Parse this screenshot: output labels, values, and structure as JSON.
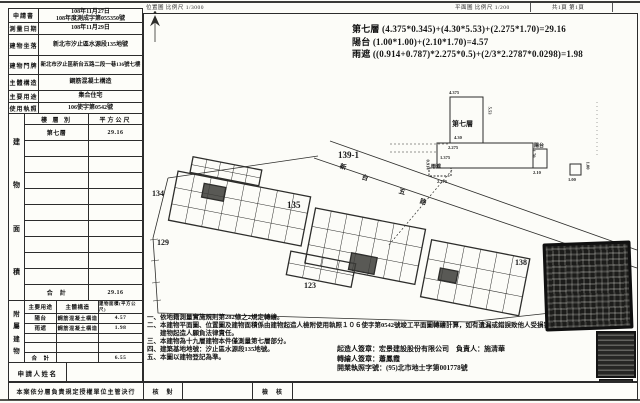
{
  "top": {
    "location_scale": "位置圖 比例尺 1/3000",
    "plan_scale": "平面圖 比例尺 1/200",
    "page_info": "共1頁 第1頁"
  },
  "calc_lines": [
    "第七層 (4.375*0.345)+(4.30*5.53)+(2.275*1.70)=29.16",
    "陽台 (1.00*1.00)+(2.10*1.70)=4.57",
    "雨遮 ((0.914+0.787)*2.275*0.5)+(2/3*2.2787*0.0298)=1.98"
  ],
  "form": {
    "fields": [
      {
        "label": "申請書",
        "lines": [
          "108年11月27日",
          "108年度測成字第055350號"
        ]
      },
      {
        "label": "測量日期",
        "lines": [
          "108年11月29日"
        ]
      },
      {
        "label": "建物坐落",
        "lines": [
          "新北市汐止區水源段135地號"
        ]
      },
      {
        "label": "建物門牌",
        "lines": [
          "新北市汐止區新台五路二段一巷136號七樓"
        ]
      },
      {
        "label": "主體構造",
        "lines": [
          "鋼筋混凝土構造"
        ]
      },
      {
        "label": "主要用途",
        "lines": [
          "集合住宅"
        ]
      },
      {
        "label": "使用執照",
        "lines": [
          "106使字第0542號"
        ]
      }
    ],
    "area_table": {
      "side_label": "建物面積",
      "headers": [
        "樓 層 別",
        "平方公尺"
      ],
      "rows": [
        [
          "第七層",
          "29.16"
        ],
        [
          "",
          ""
        ],
        [
          "",
          ""
        ],
        [
          "",
          ""
        ],
        [
          "",
          ""
        ],
        [
          "",
          ""
        ],
        [
          "",
          ""
        ],
        [
          "",
          ""
        ],
        [
          "",
          ""
        ],
        [
          "",
          ""
        ],
        [
          "合　計",
          "29.16"
        ]
      ]
    },
    "annex_table": {
      "side_label": "附屬建物",
      "headers": [
        "主要用途",
        "主體構造",
        "建物面積(平方公尺)"
      ],
      "rows": [
        [
          "陽台",
          "鋼筋混凝土構造",
          "4.57"
        ],
        [
          "雨遮",
          "鋼筋混凝土構造",
          "1.98"
        ],
        [
          "",
          "",
          ""
        ],
        [
          "",
          "",
          ""
        ],
        [
          "合　計",
          "",
          "6.55"
        ]
      ]
    },
    "applicant_label": "申請人姓名",
    "footer": {
      "decision": "本案依分層負責規定授權單位主管決行",
      "check1": "核　對",
      "check2": "檢　核"
    }
  },
  "notes": [
    "一、依地籍測量實施規則第282條之2規定轉繪。",
    "二、本建物平面圖、位置圖及建物面積係由建物起造人檢附使用執照１０６使字第0542號竣工平面圖轉繪計算，如有遺漏或錯誤致他人受損害，",
    "　　建物起造人願負法律責任。",
    "三、本建物為十九層建物本件僅測量第七層部分。",
    "四、建築基地地號：汐止區水源段135地號。",
    "五、本圖以建物登記為準。"
  ],
  "signers": [
    "起造人簽章：宏景建設股份有限公司　負責人：施清華",
    "轉繪人簽章：蕭鳳霞",
    "開業執照字號：(95)北市地士字第001778號"
  ],
  "site_plan": {
    "road_name": "新台五路",
    "road_chars": [
      {
        "ch": "新",
        "x": 340,
        "y": 161
      },
      {
        "ch": "台",
        "x": 362,
        "y": 172
      },
      {
        "ch": "五",
        "x": 399,
        "y": 186
      },
      {
        "ch": "路",
        "x": 420,
        "y": 196
      }
    ],
    "parcels": [
      {
        "text": "134",
        "x": 152,
        "y": 189,
        "fs": 8
      },
      {
        "text": "139-1",
        "x": 338,
        "y": 150,
        "fs": 9
      },
      {
        "text": "135",
        "x": 287,
        "y": 200,
        "fs": 9
      },
      {
        "text": "129",
        "x": 157,
        "y": 238,
        "fs": 8
      },
      {
        "text": "123",
        "x": 304,
        "y": 281,
        "fs": 8
      },
      {
        "text": "138",
        "x": 515,
        "y": 258,
        "fs": 8
      }
    ],
    "detail_labels": [
      {
        "text": "第七層",
        "x": 452,
        "y": 119,
        "fs": 7
      },
      {
        "text": "4.375",
        "x": 449,
        "y": 90,
        "fs": 4.5
      },
      {
        "text": "5.53",
        "x": 486,
        "y": 108,
        "fs": 4.5,
        "rot": 90
      },
      {
        "text": "4.30",
        "x": 454,
        "y": 135,
        "fs": 4.5
      },
      {
        "text": "2.275",
        "x": 448,
        "y": 145,
        "fs": 4.5
      },
      {
        "text": "1.70",
        "x": 530,
        "y": 151,
        "fs": 4.5,
        "rot": 90
      },
      {
        "text": "陽台",
        "x": 534,
        "y": 142,
        "fs": 5
      },
      {
        "text": "2.10",
        "x": 533,
        "y": 170,
        "fs": 4.5
      },
      {
        "text": "1.00",
        "x": 584,
        "y": 163,
        "fs": 4.5,
        "rot": 90
      },
      {
        "text": "1.00",
        "x": 568,
        "y": 177,
        "fs": 4.5
      },
      {
        "text": "雨遮",
        "x": 431,
        "y": 163,
        "fs": 5
      },
      {
        "text": "1.375",
        "x": 440,
        "y": 155,
        "fs": 4.5
      },
      {
        "text": "0.914",
        "x": 423,
        "y": 162,
        "fs": 4.5,
        "rot": 90
      },
      {
        "text": "2.275",
        "x": 437,
        "y": 179,
        "fs": 4.5
      }
    ]
  }
}
